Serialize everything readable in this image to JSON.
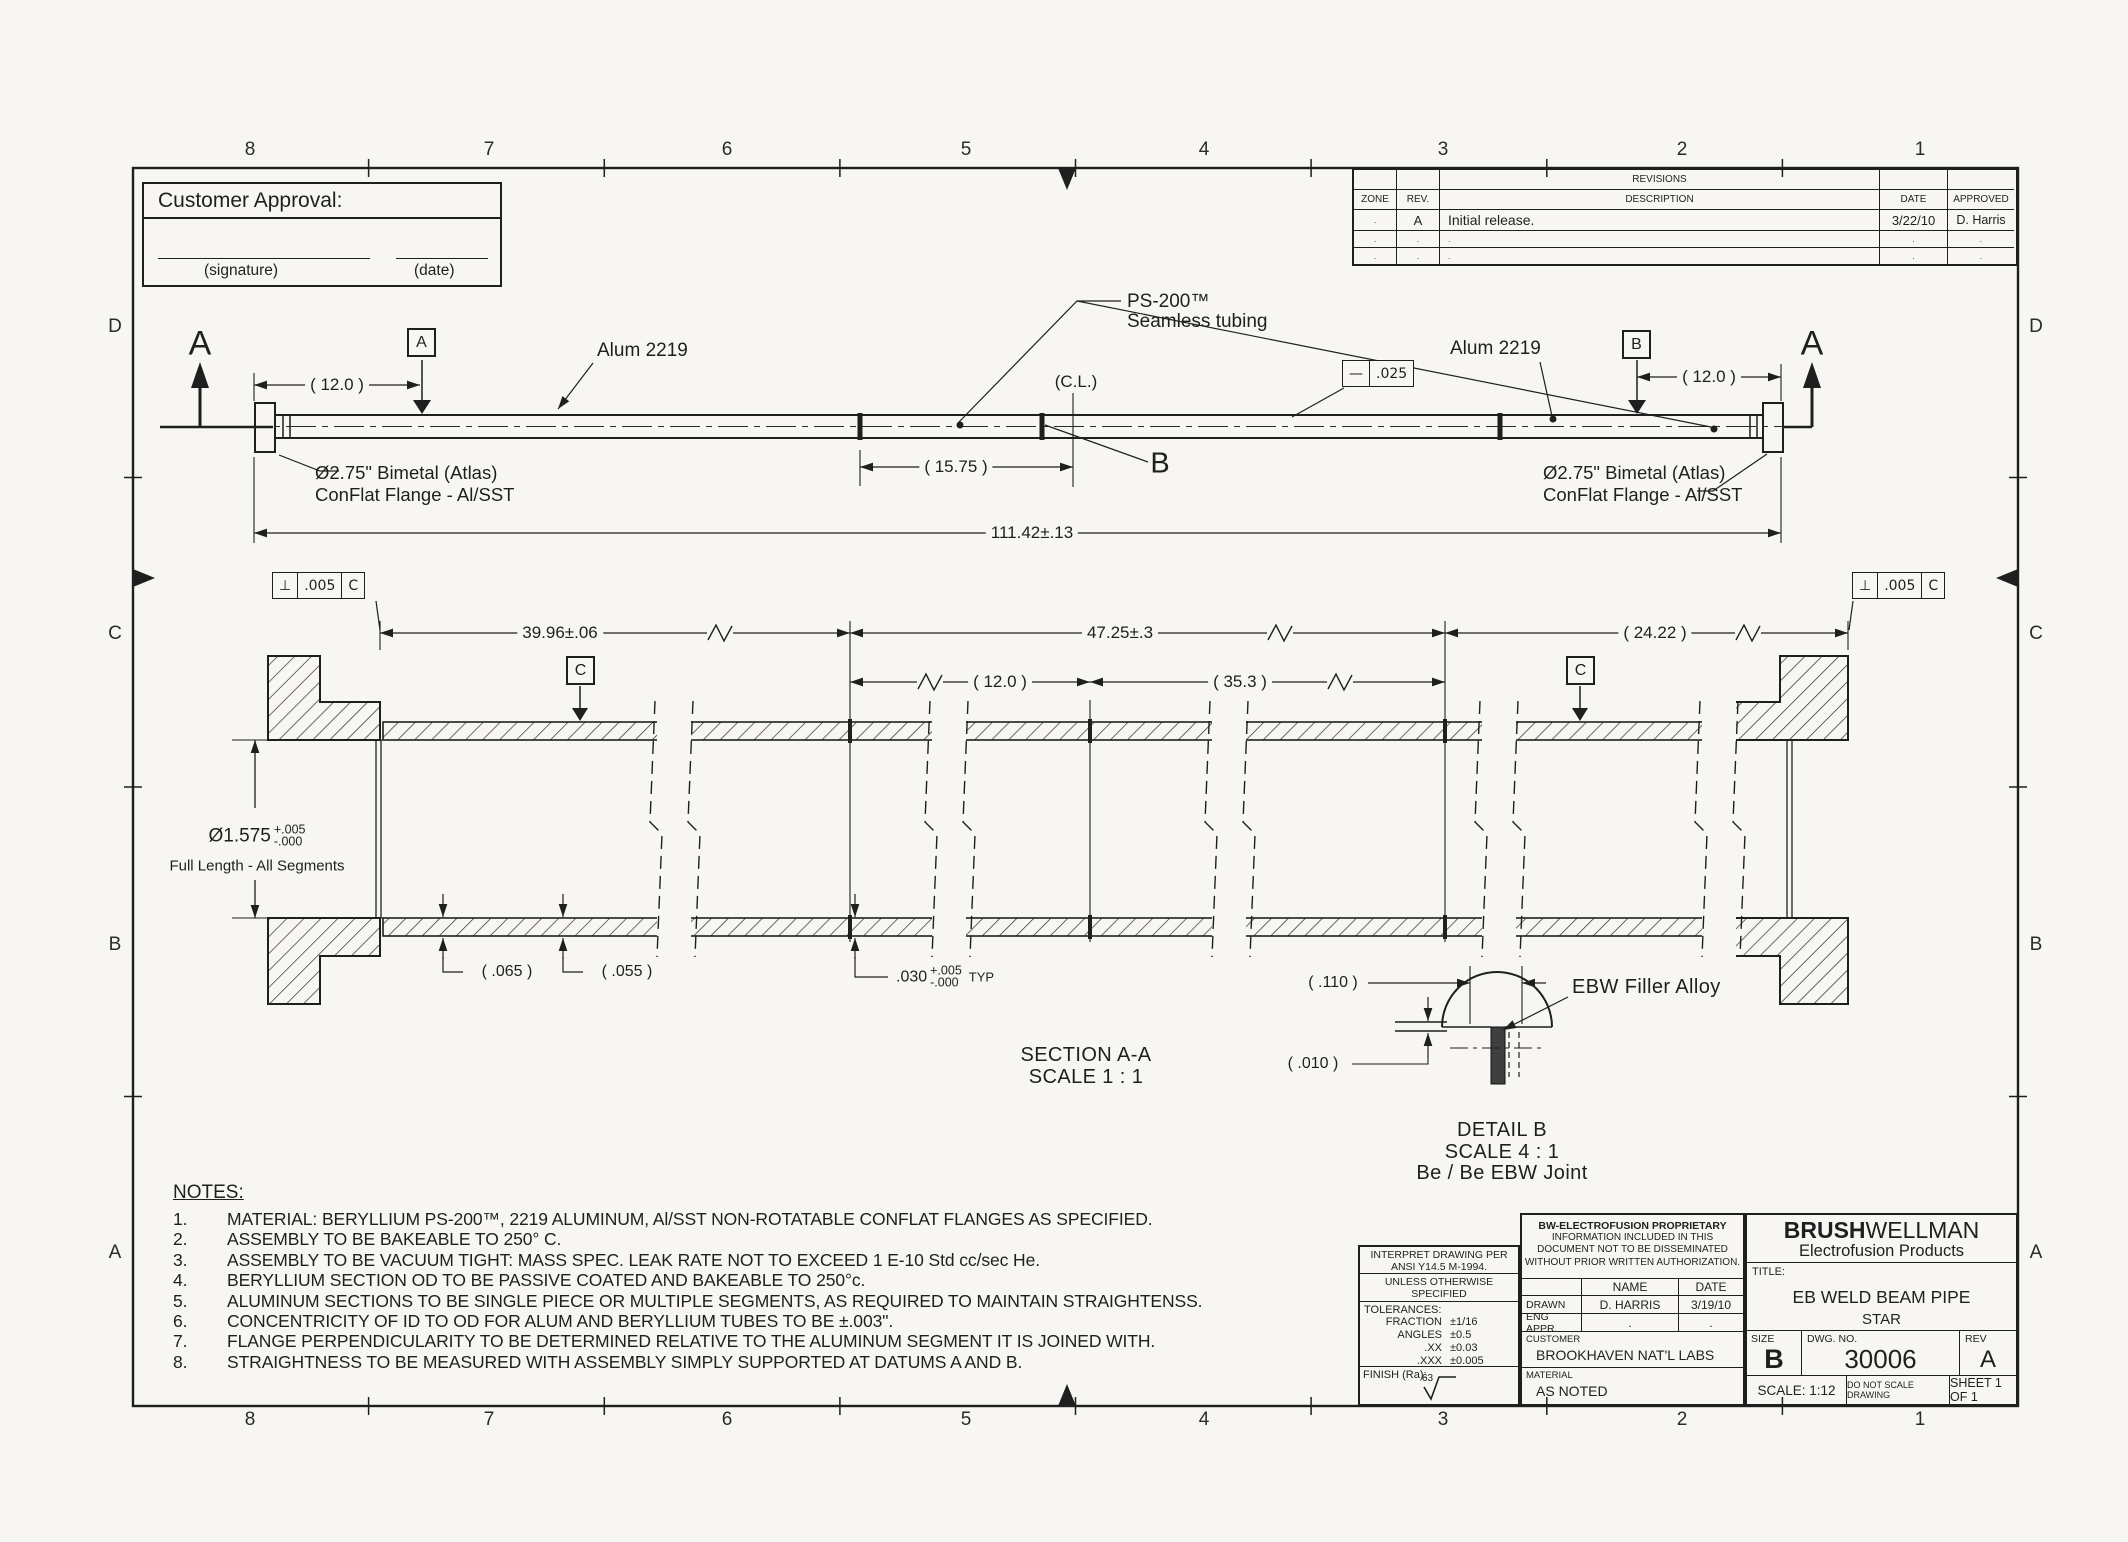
{
  "colors": {
    "paper": "#f7f6f2",
    "ink": "#1f1f1f"
  },
  "zones": {
    "top": [
      "8",
      "7",
      "6",
      "5",
      "4",
      "3",
      "2",
      "1"
    ],
    "bottom": [
      "8",
      "7",
      "6",
      "5",
      "4",
      "3",
      "2",
      "1"
    ],
    "left": [
      "D",
      "C",
      "B",
      "A"
    ],
    "right": [
      "D",
      "C",
      "B",
      "A"
    ]
  },
  "approval": {
    "title": "Customer Approval:",
    "signature_label": "(signature)",
    "date_label": "(date)"
  },
  "revisions": {
    "title": "REVISIONS",
    "col_zone": "ZONE",
    "col_rev": "REV.",
    "col_desc": "DESCRIPTION",
    "col_date": "DATE",
    "col_appr": "APPROVED",
    "rows": [
      {
        "zone": ".",
        "rev": "A",
        "desc": "Initial release.",
        "date": "3/22/10",
        "appr": "D. Harris"
      },
      {
        "zone": ".",
        "rev": ".",
        "desc": ".",
        "date": ".",
        "appr": "."
      },
      {
        "zone": ".",
        "rev": ".",
        "desc": ".",
        "date": ".",
        "appr": "."
      }
    ]
  },
  "top_view": {
    "section_label_left": "A",
    "section_label_right": "A",
    "datum_a": "A",
    "datum_b": "B",
    "dim_12_left": "( 12.0 )",
    "dim_15_75": "( 15.75 )",
    "dim_12_right": "( 12.0 )",
    "dim_overall": "111.42±.13",
    "alum_left": "Alum 2219",
    "alum_right": "Alum 2219",
    "ps200_line1": "PS-200™",
    "ps200_line2": "Seamless tubing",
    "centerline_label": "(C.L.)",
    "joint_b_label": "B",
    "fcf_straightness_sym": "—",
    "fcf_straightness_val": ".025",
    "flange_left_line1": "Ø2.75\" Bimetal (Atlas)",
    "flange_left_line2": "ConFlat Flange - Al/SST",
    "flange_right_line1": "Ø2.75\" Bimetal (Atlas)",
    "flange_right_line2": "ConFlat Flange - Al/SST"
  },
  "section_view": {
    "fcf_left_sym": "⊥",
    "fcf_left_val": ".005",
    "fcf_left_datum": "C",
    "fcf_right_sym": "⊥",
    "fcf_right_val": ".005",
    "fcf_right_datum": "C",
    "dim_39_96": "39.96±.06",
    "dim_47_25": "47.25±.3",
    "dim_24_22": "( 24.22 )",
    "dim_12": "( 12.0 )",
    "dim_35_3": "( 35.3 )",
    "datum_c_left": "C",
    "datum_c_right": "C",
    "dia_value": "Ø1.575",
    "dia_tol_plus": "+.005",
    "dia_tol_minus": "-.000",
    "dia_note": "Full Length - All Segments",
    "dim_065": "( .065 )",
    "dim_055": "( .055 )",
    "dim_030": ".030",
    "dim_030_plus": "+.005",
    "dim_030_minus": "-.000",
    "dim_030_suffix": "TYP",
    "caption_line1": "SECTION A-A",
    "caption_line2": "SCALE 1 : 1"
  },
  "detail_b": {
    "dim_110": "( .110 )",
    "dim_010": "( .010 )",
    "filler_label": "EBW Filler Alloy",
    "caption_line1": "DETAIL B",
    "caption_line2": "SCALE 4 : 1",
    "caption_line3": "Be / Be EBW Joint"
  },
  "notes": {
    "title": "NOTES:",
    "items": [
      {
        "num": "1.",
        "text": "MATERIAL:  BERYLLIUM PS-200™, 2219 ALUMINUM, Al/SST  NON-ROTATABLE CONFLAT FLANGES AS SPECIFIED."
      },
      {
        "num": "2.",
        "text": "ASSEMBLY TO BE BAKEABLE TO 250° C."
      },
      {
        "num": "3.",
        "text": "ASSEMBLY TO BE VACUUM TIGHT: MASS SPEC. LEAK RATE NOT TO EXCEED 1 E-10 Std cc/sec He."
      },
      {
        "num": "4.",
        "text": "BERYLLIUM SECTION OD TO BE PASSIVE COATED AND BAKEABLE TO 250°c."
      },
      {
        "num": "5.",
        "text": "ALUMINUM SECTIONS TO BE SINGLE PIECE OR MULTIPLE SEGMENTS, AS REQUIRED TO MAINTAIN STRAIGHTENSS."
      },
      {
        "num": "6.",
        "text": "CONCENTRICITY OF ID TO OD FOR ALUM AND BERYLLIUM TUBES TO BE ±.003\"."
      },
      {
        "num": "7.",
        "text": "FLANGE PERPENDICULARITY TO BE DETERMINED RELATIVE TO THE ALUMINUM SEGMENT IT IS JOINED WITH."
      },
      {
        "num": "8.",
        "text": "STRAIGHTNESS TO BE MEASURED WITH ASSEMBLY SIMPLY SUPPORTED AT DATUMS A AND B."
      }
    ]
  },
  "title_block": {
    "interpret1": "INTERPRET DRAWING PER",
    "interpret2": "ANSI Y14.5 M-1994.",
    "unless1": "UNLESS OTHERWISE SPECIFIED",
    "unless2": "DIMENSIONS ARE IN INCHES",
    "tol_title": "TOLERANCES:",
    "tol_rows": [
      {
        "k": "FRACTION",
        "v": "±1/16"
      },
      {
        "k": "ANGLES",
        "v": "±0.5"
      },
      {
        "k": ".XX",
        "v": "±0.03"
      },
      {
        "k": ".XXX",
        "v": "±0.005"
      }
    ],
    "finish_label": "FINISH (Ra):",
    "finish_value": "63",
    "prop1": "BW-ELECTROFUSION PROPRIETARY",
    "prop2": "INFORMATION INCLUDED IN THIS",
    "prop3": "DOCUMENT NOT TO BE DISSEMINATED",
    "prop4": "WITHOUT PRIOR WRITTEN AUTHORIZATION.",
    "col_name": "NAME",
    "col_date": "DATE",
    "drawn_label": "DRAWN",
    "drawn_name": "D. HARRIS",
    "drawn_date": "3/19/10",
    "eng_label": "ENG APPR.",
    "eng_name": ".",
    "eng_date": ".",
    "customer_label": "CUSTOMER",
    "customer_value": "BROOKHAVEN NAT'L LABS",
    "material_label": "MATERIAL",
    "material_value": "AS NOTED",
    "brand_bold": "BRUSH",
    "brand_rest": "WELLMAN",
    "brand_sub": "Electrofusion Products",
    "title_label": "TITLE:",
    "title_line1": "EB WELD BEAM PIPE",
    "title_line2": "STAR",
    "size_label": "SIZE",
    "size_value": "B",
    "dwg_label": "DWG. NO.",
    "dwg_value": "30006",
    "rev_label": "REV",
    "rev_value": "A",
    "scale": "SCALE: 1:12",
    "no_scale": "DO NOT SCALE DRAWING",
    "sheet": "SHEET 1 OF 1"
  }
}
